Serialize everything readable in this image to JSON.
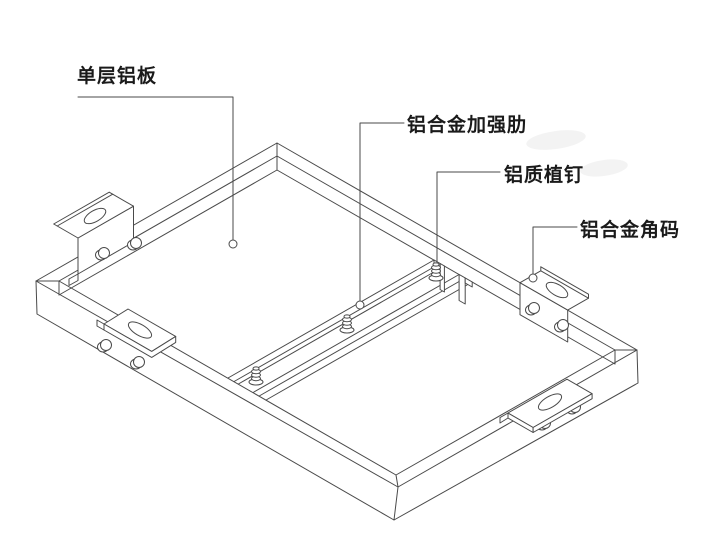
{
  "diagram": {
    "background": "#ffffff",
    "line_color": "#4a4a4a",
    "text_color": "#1a1a1a",
    "labels": [
      {
        "id": "single-layer-aluminum-panel",
        "text": "单层铝板"
      },
      {
        "id": "aluminum-alloy-reinforcing-rib",
        "text": "铝合金加强肋"
      },
      {
        "id": "aluminum-stud",
        "text": "铝质植钉"
      },
      {
        "id": "aluminum-alloy-corner-bracket",
        "text": "铝合金角码"
      }
    ]
  }
}
